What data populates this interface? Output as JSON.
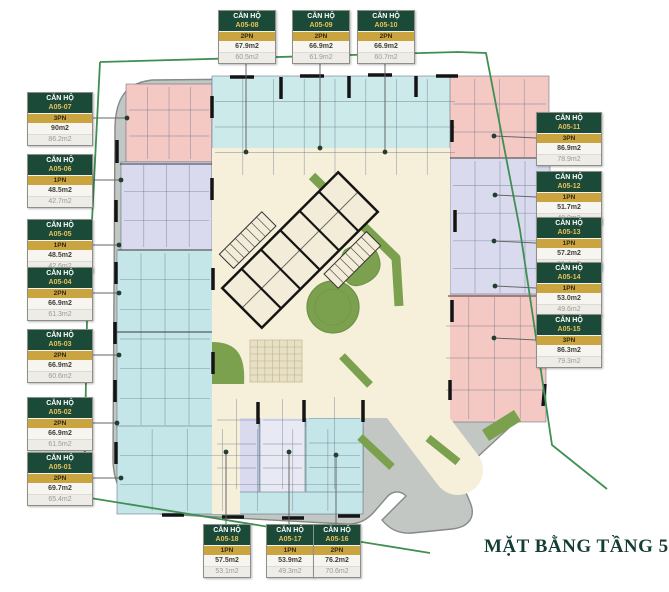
{
  "title": "MẶT BẰNG TẦNG 5",
  "label_header": "CĂN HỘ",
  "units": [
    {
      "id": "A05-07",
      "bedrooms": "3PN",
      "area_gross": "90m2",
      "area_net": "86.2m2"
    },
    {
      "id": "A05-06",
      "bedrooms": "1PN",
      "area_gross": "48.5m2",
      "area_net": "42.7m2"
    },
    {
      "id": "A05-05",
      "bedrooms": "1PN",
      "area_gross": "48.5m2",
      "area_net": "42.6m2"
    },
    {
      "id": "A05-04",
      "bedrooms": "2PN",
      "area_gross": "66.9m2",
      "area_net": "61.3m2"
    },
    {
      "id": "A05-03",
      "bedrooms": "2PN",
      "area_gross": "66.9m2",
      "area_net": "60.6m2"
    },
    {
      "id": "A05-02",
      "bedrooms": "2PN",
      "area_gross": "66.9m2",
      "area_net": "61.5m2"
    },
    {
      "id": "A05-01",
      "bedrooms": "2PN",
      "area_gross": "69.7m2",
      "area_net": "65.4m2"
    },
    {
      "id": "A05-08",
      "bedrooms": "2PN",
      "area_gross": "67.9m2",
      "area_net": "60.5m2"
    },
    {
      "id": "A05-09",
      "bedrooms": "2PN",
      "area_gross": "66.9m2",
      "area_net": "61.9m2"
    },
    {
      "id": "A05-10",
      "bedrooms": "2PN",
      "area_gross": "66.9m2",
      "area_net": "60.7m2"
    },
    {
      "id": "A05-11",
      "bedrooms": "3PN",
      "area_gross": "86.9m2",
      "area_net": "78.9m2"
    },
    {
      "id": "A05-12",
      "bedrooms": "1PN",
      "area_gross": "51.7m2",
      "area_net": "48.9m2"
    },
    {
      "id": "A05-13",
      "bedrooms": "1PN",
      "area_gross": "57.2m2",
      "area_net": "51.4m2"
    },
    {
      "id": "A05-14",
      "bedrooms": "1PN",
      "area_gross": "53.0m2",
      "area_net": "49.6m2"
    },
    {
      "id": "A05-15",
      "bedrooms": "3PN",
      "area_gross": "86.3m2",
      "area_net": "79.3m2"
    },
    {
      "id": "A05-18",
      "bedrooms": "1PN",
      "area_gross": "57.5m2",
      "area_net": "53.1m2"
    },
    {
      "id": "A05-17",
      "bedrooms": "1PN",
      "area_gross": "53.9m2",
      "area_net": "49.3m2"
    },
    {
      "id": "A05-16",
      "bedrooms": "2PN",
      "area_gross": "76.2m2",
      "area_net": "70.6m2"
    }
  ],
  "colors": {
    "boundary": "#3f8f53",
    "building_band": "#c3c7c3",
    "building_edge": "#868a86",
    "cream": "#f6efda",
    "core_fill": "#f3ecd8",
    "grass": "#7ba14f",
    "grass_dark": "#6b9245",
    "paving": "#e8e0c4",
    "pink": "#f4c9c4",
    "periwinkle": "#d9daee",
    "periwinkle_light": "#e9e9f4",
    "cyan": "#c5e6e8",
    "cyan_light": "#cdeaea",
    "wall": "#141414",
    "room_line": "#54687f",
    "label_green": "#1c4a39",
    "label_gold": "#c9a43f",
    "title_color": "#143d36"
  }
}
